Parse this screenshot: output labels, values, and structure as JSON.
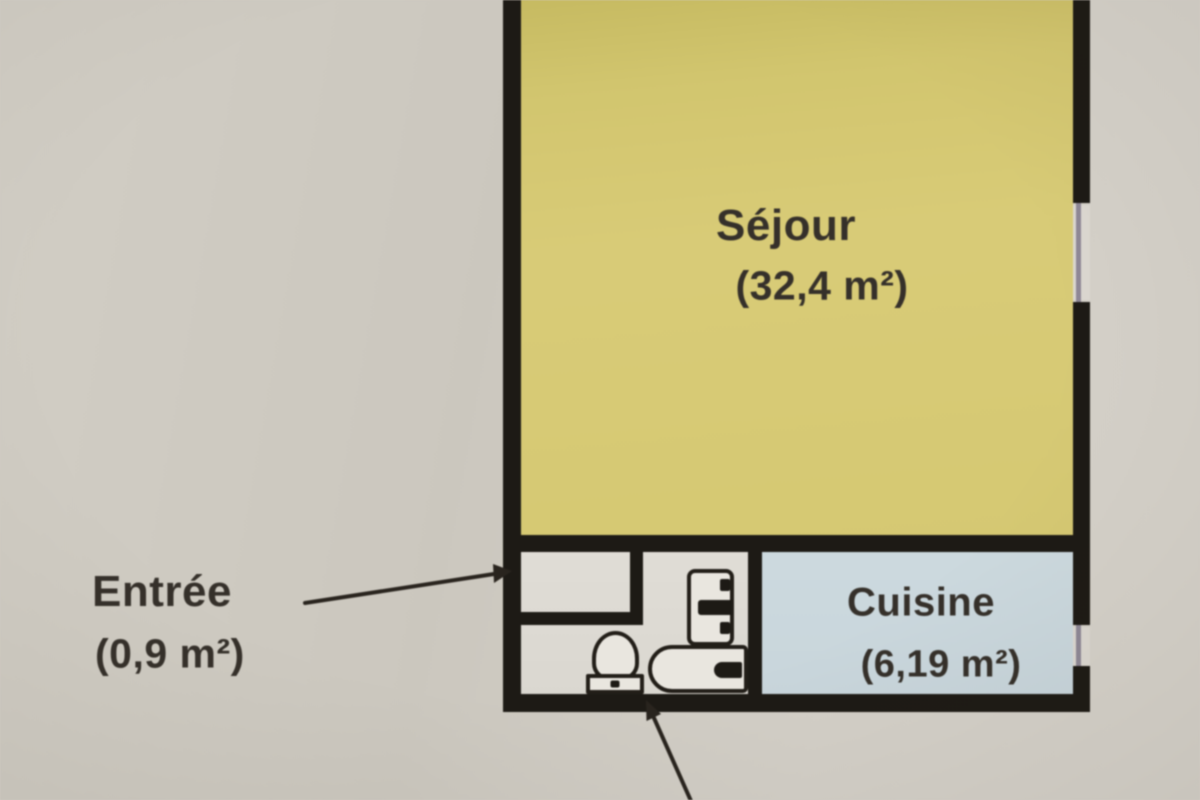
{
  "plan": {
    "rooms": {
      "sejour": {
        "name": "Séjour",
        "area": "(32,4 m²)"
      },
      "entree": {
        "name": "Entrée",
        "area": "(0,9 m²)"
      },
      "cuisine": {
        "name": "Cuisine",
        "area": "(6,19 m²)"
      }
    },
    "fixtures": {
      "toilet": "toilet",
      "bathtub": "bathtub",
      "washbasin": "washbasin"
    },
    "windows": [
      "sejour-right-window",
      "cuisine-right-window"
    ],
    "colors": {
      "background": "#d0ccc3",
      "sejour_fill": "#d5c86f",
      "cuisine_fill": "#ccd9de",
      "floor_fill": "#e0ddd6",
      "wall": "#1d1a15",
      "text": "#35302a",
      "window_line": "#8e8795"
    }
  }
}
